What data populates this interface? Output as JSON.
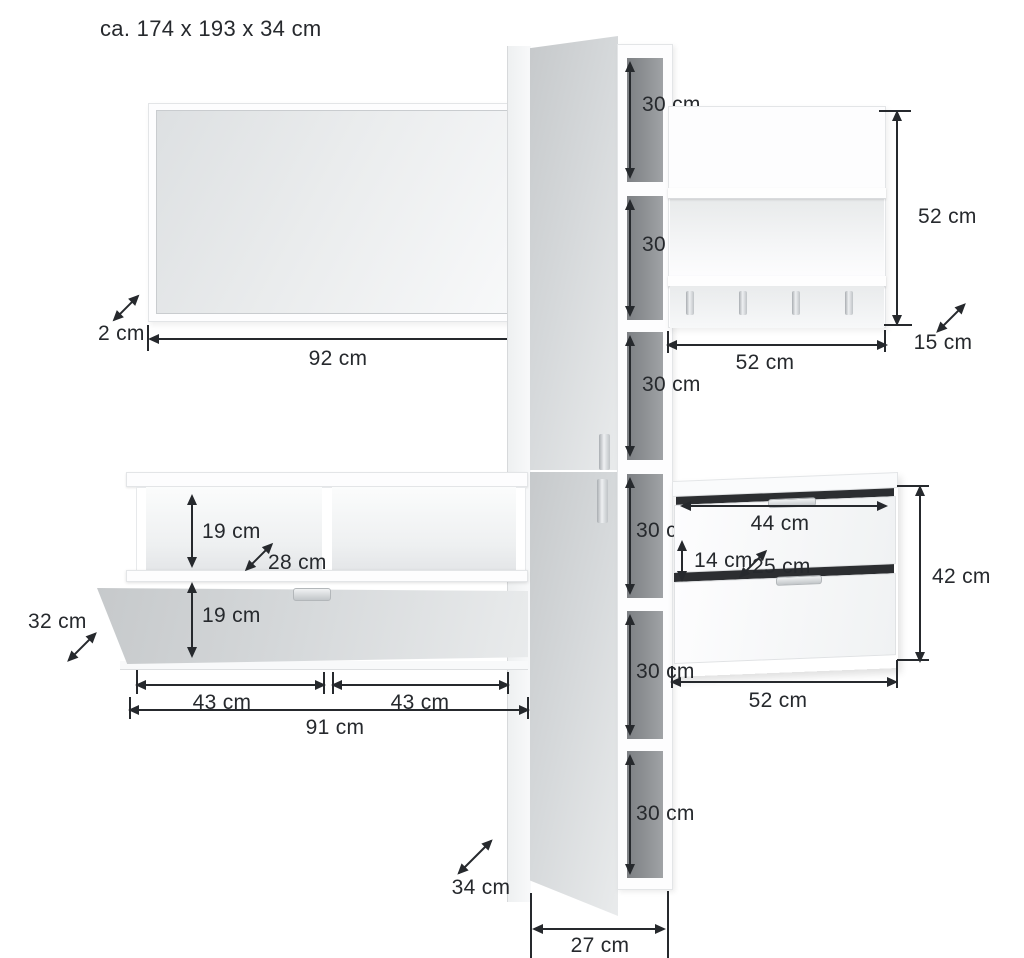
{
  "title": "ca. 174 x 193 x 34 cm",
  "mirror": {
    "depth": "2 cm",
    "width": "92 cm"
  },
  "shelf_column": {
    "compartments": [
      "30 cm",
      "30 cm",
      "30 cm",
      "30 cm",
      "30 cm",
      "30 cm"
    ],
    "depth": "34 cm",
    "width": "27 cm"
  },
  "coat_rack": {
    "height": "52 cm",
    "width": "52 cm",
    "depth": "15 cm"
  },
  "bench": {
    "upper_compartment_height": "19 cm",
    "compartment_depth": "28 cm",
    "door_height": "19 cm",
    "depth": "32 cm",
    "left_compartment_width": "43 cm",
    "right_compartment_width": "43 cm",
    "total_width": "91 cm"
  },
  "drawer_unit": {
    "drawer_inner_width": "44 cm",
    "drawer_inner_height": "14 cm",
    "drawer_inner_depth": "25 cm",
    "height": "42 cm",
    "width": "52 cm"
  },
  "colors": {
    "line": "#26292d",
    "door_gloss_light": "#e9ebec",
    "door_gloss_dark": "#c6c9cb",
    "interior_dark": "#85888b",
    "background": "#ffffff"
  }
}
